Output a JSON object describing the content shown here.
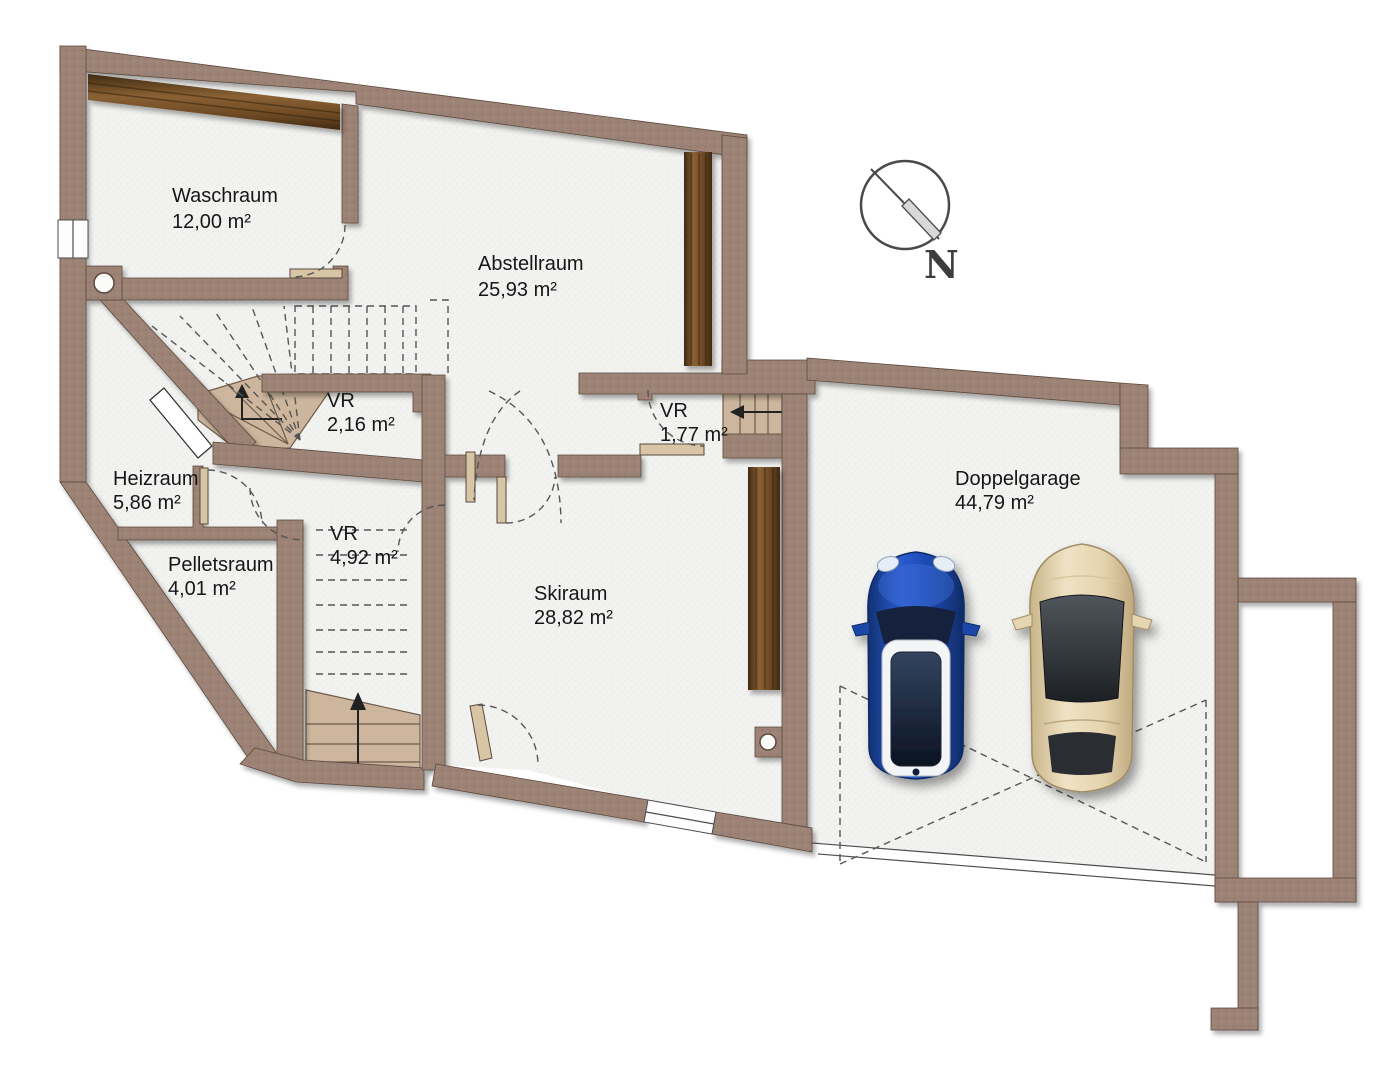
{
  "rooms": [
    {
      "name": "Waschraum",
      "area": "12,00 m²"
    },
    {
      "name": "Abstellraum",
      "area": "25,93 m²"
    },
    {
      "name": "VR",
      "area": "2,16 m²"
    },
    {
      "name": "VR",
      "area": "1,77 m²"
    },
    {
      "name": "Heizraum",
      "area": "5,86 m²"
    },
    {
      "name": "VR",
      "area": "4,92 m²"
    },
    {
      "name": "Pelletsraum",
      "area": "4,01 m²"
    },
    {
      "name": "Skiraum",
      "area": "28,82 m²"
    },
    {
      "name": "Doppelgarage",
      "area": "44,79 m²"
    }
  ],
  "compass": {
    "label": "N"
  },
  "colors": {
    "wall": "#9d8276",
    "wall_edge": "#5c4a3e",
    "floor": "#f2f3f1",
    "wood_dark": "#3f2a12",
    "wood_mid": "#6b4722",
    "wood_light": "#8a6134",
    "step": "#cdb69d",
    "door_leaf": "#d8c5a5",
    "dash_line": "#555555",
    "car_blue": "#2a5bd0",
    "car_blue_dark": "#123172",
    "car_beige": "#efe2c4",
    "car_beige_dark": "#c9b489",
    "glass_dark": "#1c2023"
  }
}
